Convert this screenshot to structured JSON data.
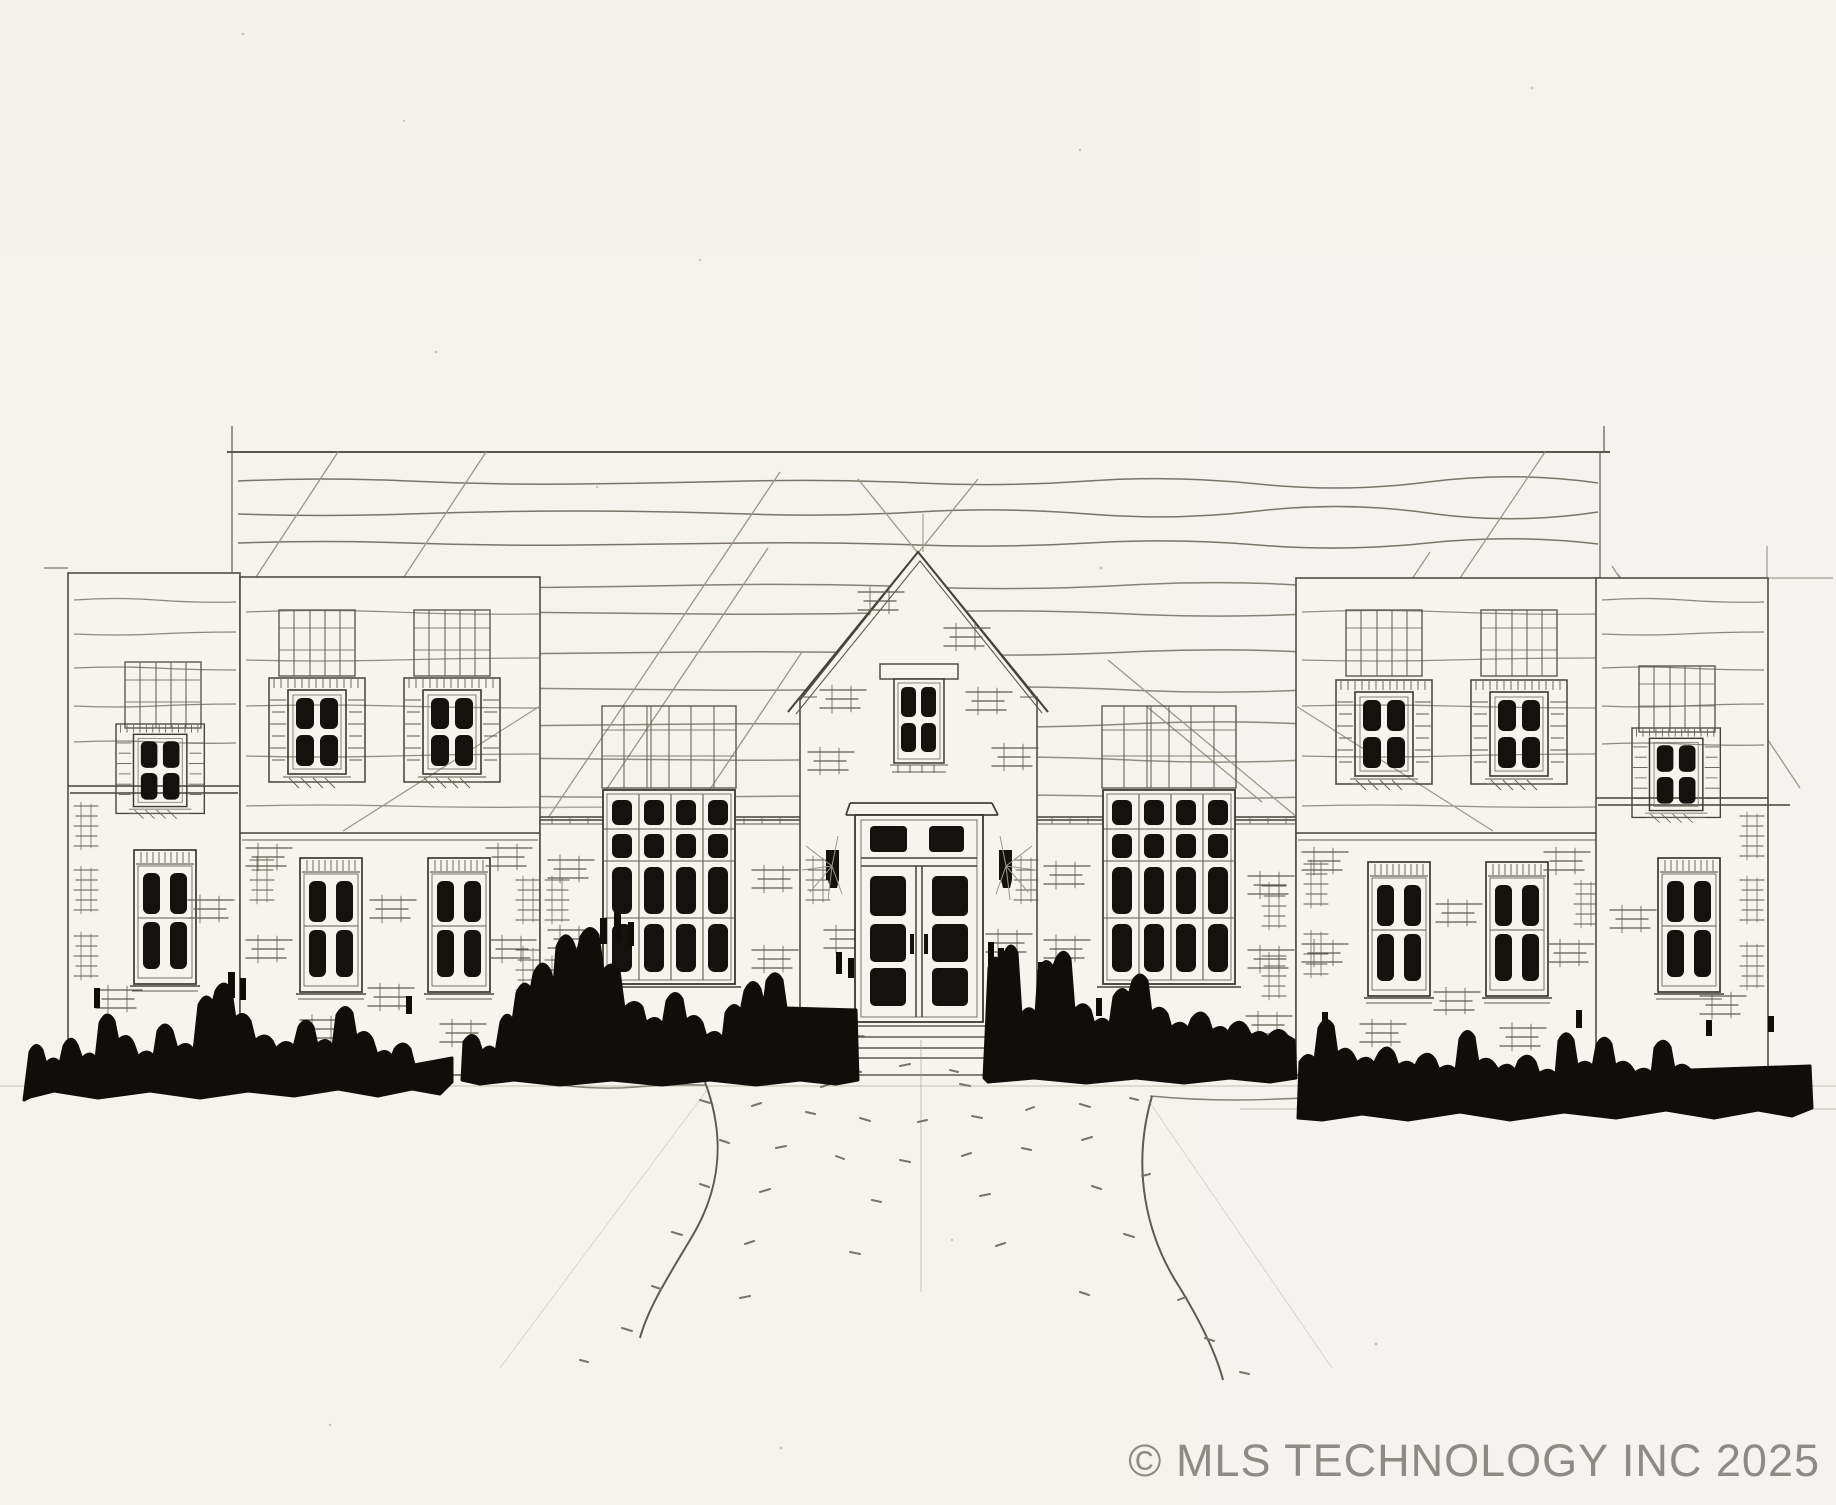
{
  "meta": {
    "kind": "architectural-elevation-sketch",
    "description": "Hand-drawn front elevation sketch (pencil and ink) of a large symmetric two-story house: center gabled entry with double doors and transom, flanking mansard-roofed blocks with dormer windows, low side wings, tall multi-pane window bays, solid black hedge silhouettes along the foundation and a curved stippled entry walk."
  },
  "watermark": {
    "text": "© MLS TECHNOLOGY INC 2025",
    "color": "#8d8b86"
  },
  "palette": {
    "paper": "#f5f3ee",
    "pencil_dark": "#46423a",
    "pencil_medium": "#5f5a50",
    "pencil_light": "#9c968b",
    "ink_black": "#14110e"
  },
  "scene": {
    "building": {
      "stories": 2,
      "center": "gabled entry bay with small four-pane gable window, cornice, double entry doors with transom and flanking sconces",
      "left_side": [
        "low side wing with dormer window and lower window",
        "two-story block with two dormer windows and two ground-floor windows",
        "tall sixteen-pane window bay"
      ],
      "right_side": [
        "tall sixteen-pane window bay",
        "two-story block with two dormer windows and two ground-floor windows",
        "low side wing with dormer window and lower window"
      ],
      "roof": "long ridge with sketched shingle courses and diagonal construction lines"
    },
    "window_counts": {
      "dormer_windows": 6,
      "ground_floor_windows": 6,
      "tall_bay_windows": 2,
      "gable_window": 1,
      "entry_doors": 1
    },
    "landscape": {
      "hedges": "four solid dark shrub masses along the foundation",
      "walkway": "center entry steps with flaring curved walk edges and stippled paving"
    }
  }
}
